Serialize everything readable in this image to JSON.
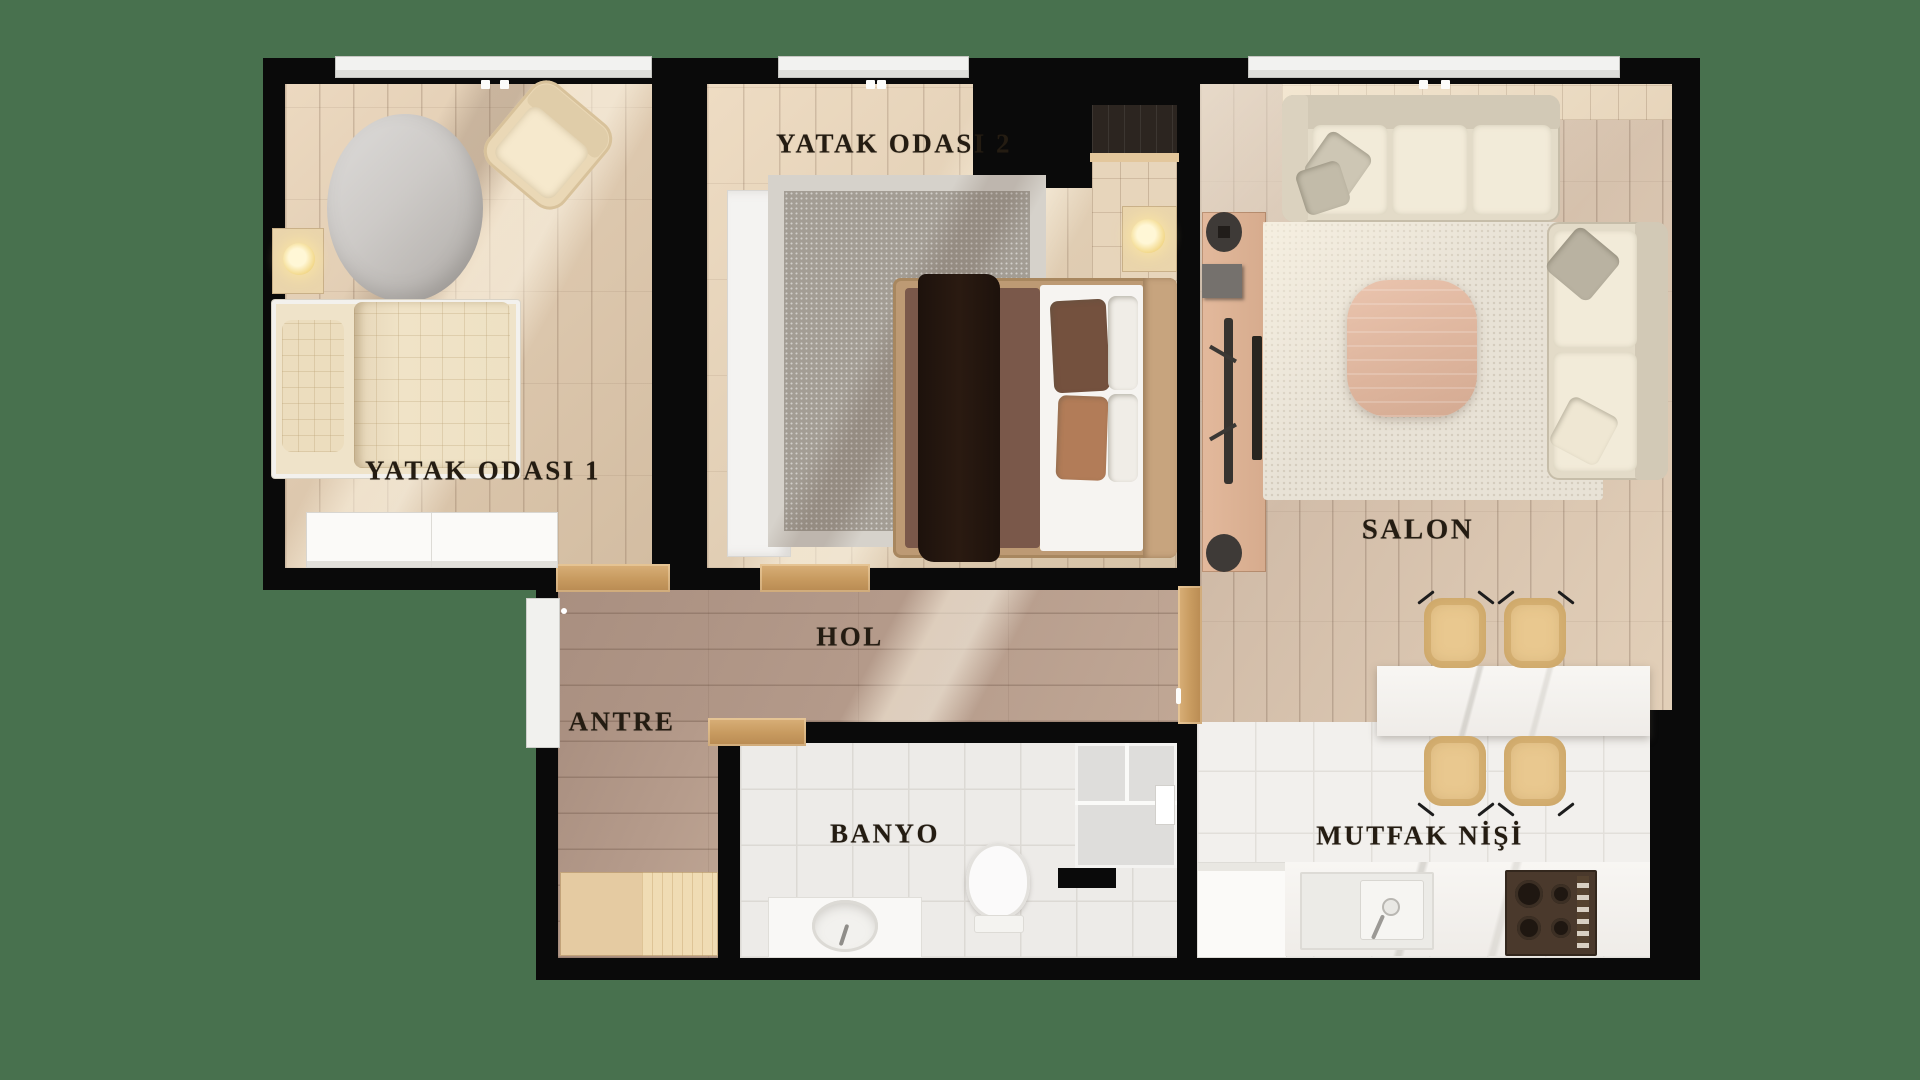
{
  "title": "Apartment floor plan (2+1) top-down render",
  "scene": {
    "background_color": "#48714E",
    "wall_color": "#0a0a0a",
    "floor_wood_light": "#e0cdb3",
    "floor_wood_taupe": "#b0978a",
    "tile_white": "#efedea",
    "accent_wood_door": "#c79a5f",
    "lamp_glow": "#f7e3a0"
  },
  "rooms": [
    {
      "id": "bedroom-1",
      "label": "YATAK ODASI 1"
    },
    {
      "id": "bedroom-2",
      "label": "YATAK ODASI 2"
    },
    {
      "id": "living-room",
      "label": "SALON"
    },
    {
      "id": "hall",
      "label": "HOL"
    },
    {
      "id": "entry",
      "label": "ANTRE"
    },
    {
      "id": "bathroom",
      "label": "BANYO"
    },
    {
      "id": "kitchen-niche",
      "label": "MUTFAK NİŞİ"
    }
  ],
  "furniture": [
    "single-bed",
    "round-rug",
    "armchair",
    "nightstand-lamp",
    "dresser",
    "wardrobe",
    "double-bed",
    "checkered-rug",
    "sectional-sofa",
    "tv-console",
    "tv",
    "coffee-table",
    "area-rug",
    "breakfast-bar",
    "bar-chairs",
    "vanity-sink",
    "toilet",
    "shower-enclosure",
    "kitchen-counter",
    "kitchen-sink",
    "gas-hob",
    "appliance",
    "entry-cabinet",
    "entry-door"
  ]
}
